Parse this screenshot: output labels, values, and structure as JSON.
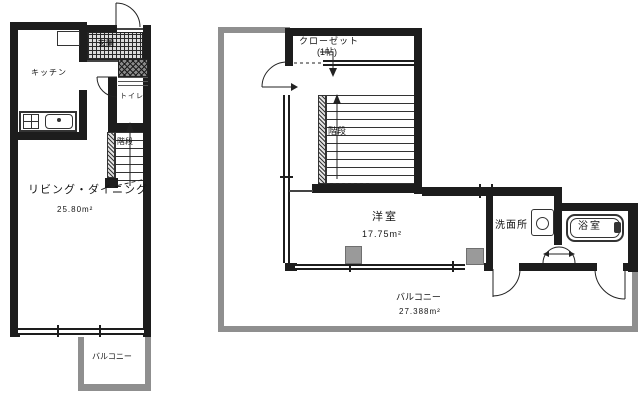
{
  "title": "floor-plan",
  "colors": {
    "wall": "#1d1d1d",
    "balcony_railing": "#8f8f8f",
    "pillar": "#9a9a9a",
    "background": "#ffffff"
  },
  "left_plan": {
    "kitchen_label": "キッチン",
    "entrance_label": "玄関",
    "toilet_label": "トイレ",
    "stairs_label": "階段",
    "living_label": "リビング・ダイニング",
    "living_area": "25.80m²",
    "balcony_label": "バルコニー"
  },
  "right_plan": {
    "closet_label": "クローゼット",
    "closet_size_label": "(1帖)",
    "stairs_label": "階段",
    "room_label": "洋室",
    "room_area": "17.75m²",
    "washroom_label": "洗面所",
    "bath_label": "浴室",
    "balcony_label": "バルコニー",
    "balcony_area": "27.388m²"
  }
}
